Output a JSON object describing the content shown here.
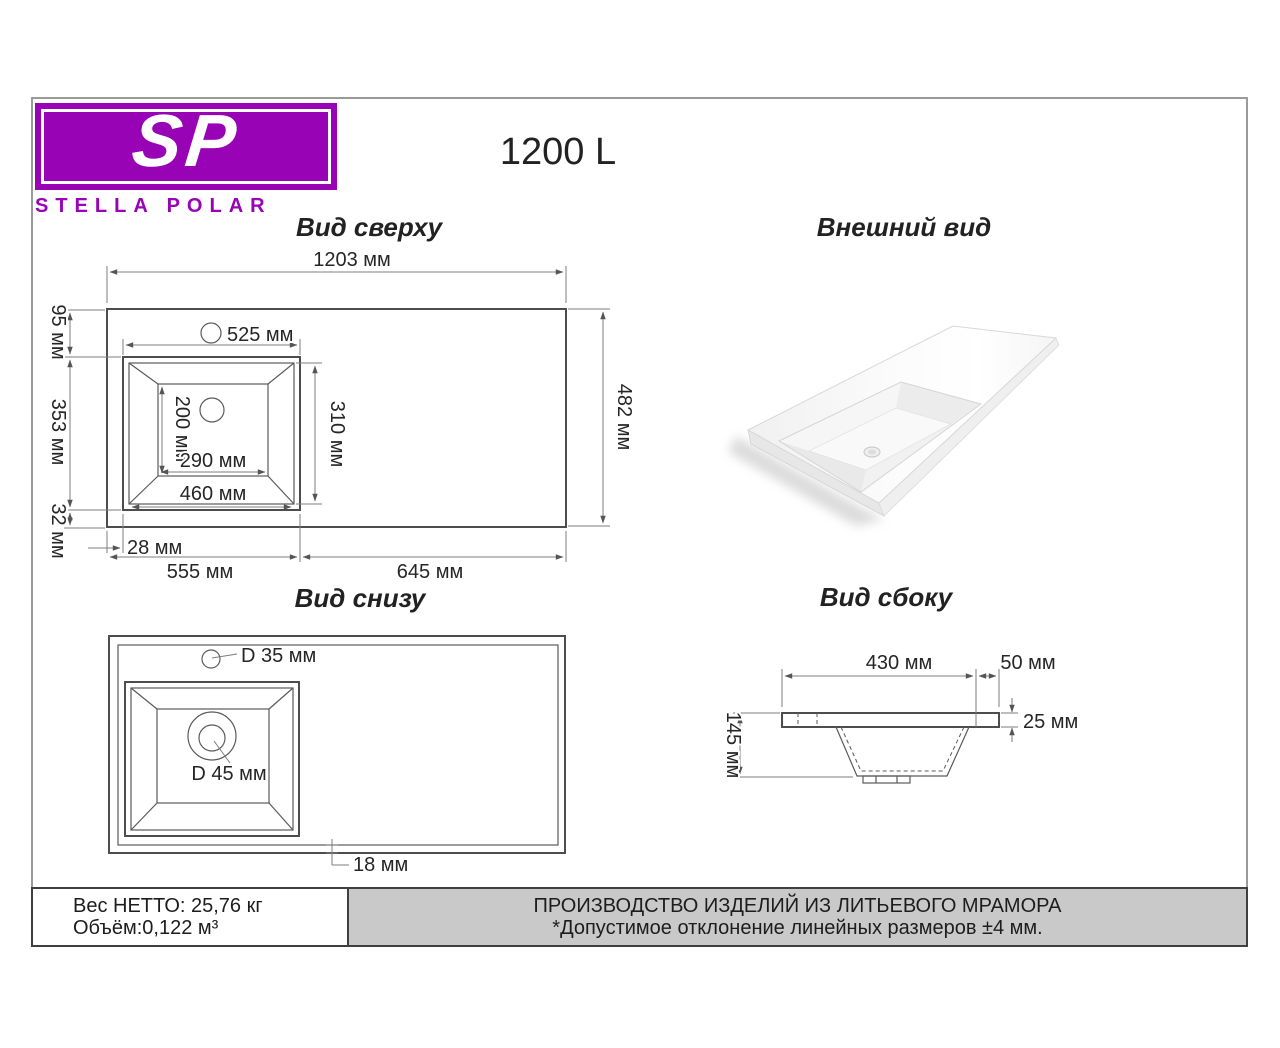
{
  "brand": {
    "initials": "SP",
    "name": "STELLA POLAR",
    "purple": "#9703b5"
  },
  "title": "1200 L",
  "views": {
    "top": {
      "heading": "Вид сверху",
      "dims": {
        "total_width": "1203 мм",
        "total_depth": "482 мм",
        "edge_top": "95 мм",
        "basin_depth": "353 мм",
        "edge_bottom": "32 мм",
        "basin_width": "525 мм",
        "inner_depth": "310 мм",
        "bottom_depth": "200 мм",
        "bottom_width": "290 мм",
        "basin_bottom_width": "460 мм",
        "offset_left": "28 мм",
        "span_left": "555 мм",
        "span_right": "645 мм"
      }
    },
    "external": {
      "heading": "Внешний вид"
    },
    "bottom": {
      "heading": "Вид снизу",
      "dims": {
        "faucet_hole": "D 35 мм",
        "drain_hole": "D 45 мм",
        "wall_thickness": "18 мм"
      }
    },
    "side": {
      "heading": "Вид сбоку",
      "dims": {
        "basin_width": "430 мм",
        "ledge_width": "50 мм",
        "counter_thickness": "25 мм",
        "total_height": "145 мм"
      }
    }
  },
  "footer": {
    "weight": "Вес НЕТТО: 25,76 кг",
    "volume": "Объём:0,122 м³",
    "production": "ПРОИЗВОДСТВО ИЗДЕЛИЙ ИЗ ЛИТЬЕВОГО МРАМОРА",
    "tolerance": "*Допустимое отклонение линейных размеров ±4 мм."
  }
}
